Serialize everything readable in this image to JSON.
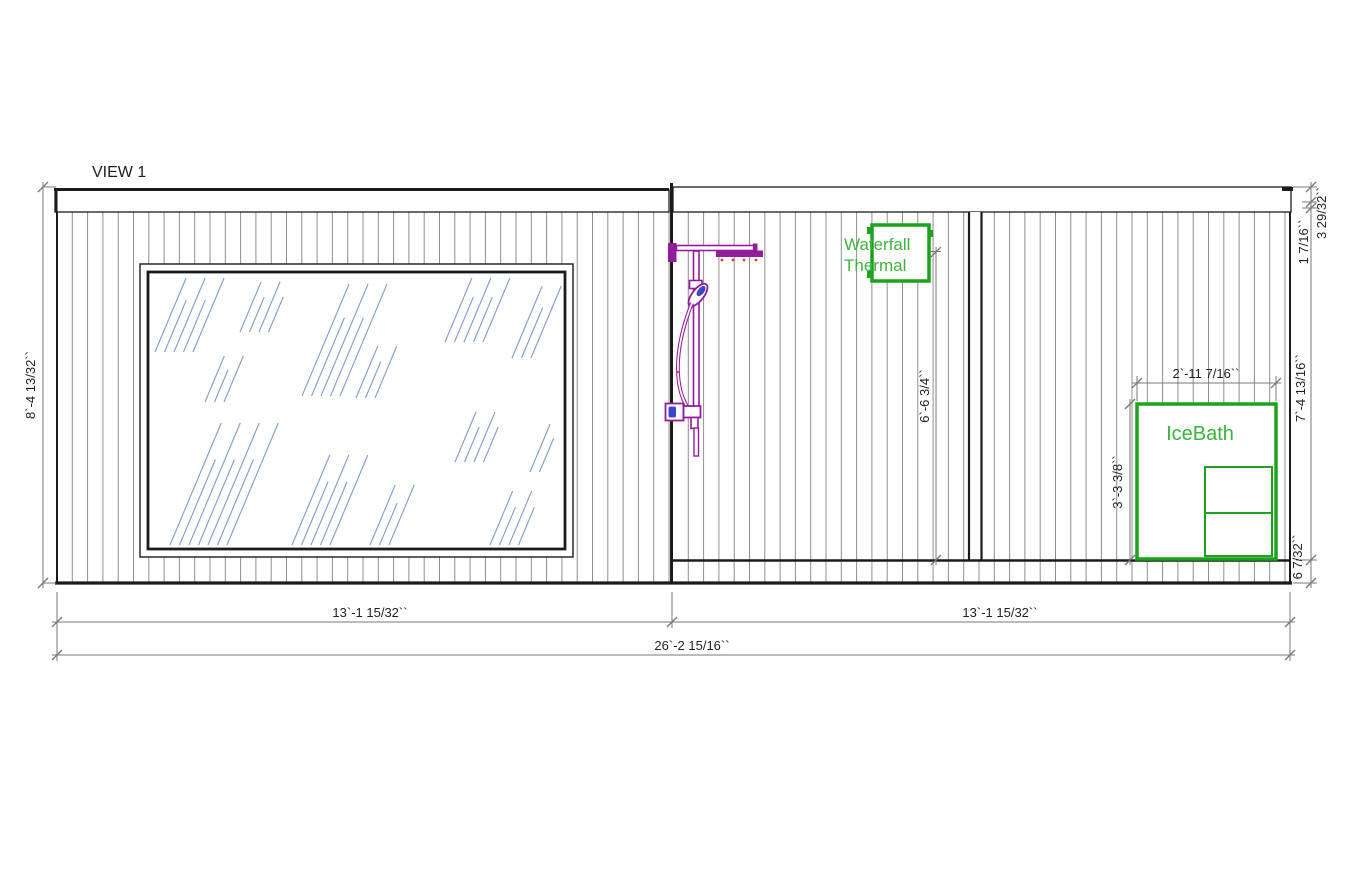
{
  "drawing": {
    "view_label": "VIEW 1",
    "labels": {
      "waterfall_line1": "Waterfall",
      "waterfall_line2": "Thermal",
      "icebath": "IceBath"
    },
    "dimensions": {
      "overall_height": "8`-4 13/32``",
      "left_section_width": "13`-1 15/32``",
      "right_section_width": "13`-1 15/32``",
      "overall_width": "26`-2 15/16``",
      "shower_zone_height": "6`-6 3/4``",
      "icebath_width": "2`-11 7/16``",
      "icebath_height": "3`-3 3/8``",
      "right_roof_cap": "3 29/32``",
      "right_roof_edge": "1 7/16``",
      "right_wall_height": "7`-4 13/16``",
      "right_base_height": "6 7/32``"
    }
  },
  "colors": {
    "green": "#1ca21c",
    "green_text": "#3cb43c",
    "purple": "#911d9b",
    "blue": "#3b49c9",
    "red": "#e03a3a",
    "glass": "#7e9bd0",
    "wall_line": "#1b1b1b",
    "siding": "#8f8f8f",
    "dim": "#787878",
    "dim_text": "#1f1f1f"
  }
}
